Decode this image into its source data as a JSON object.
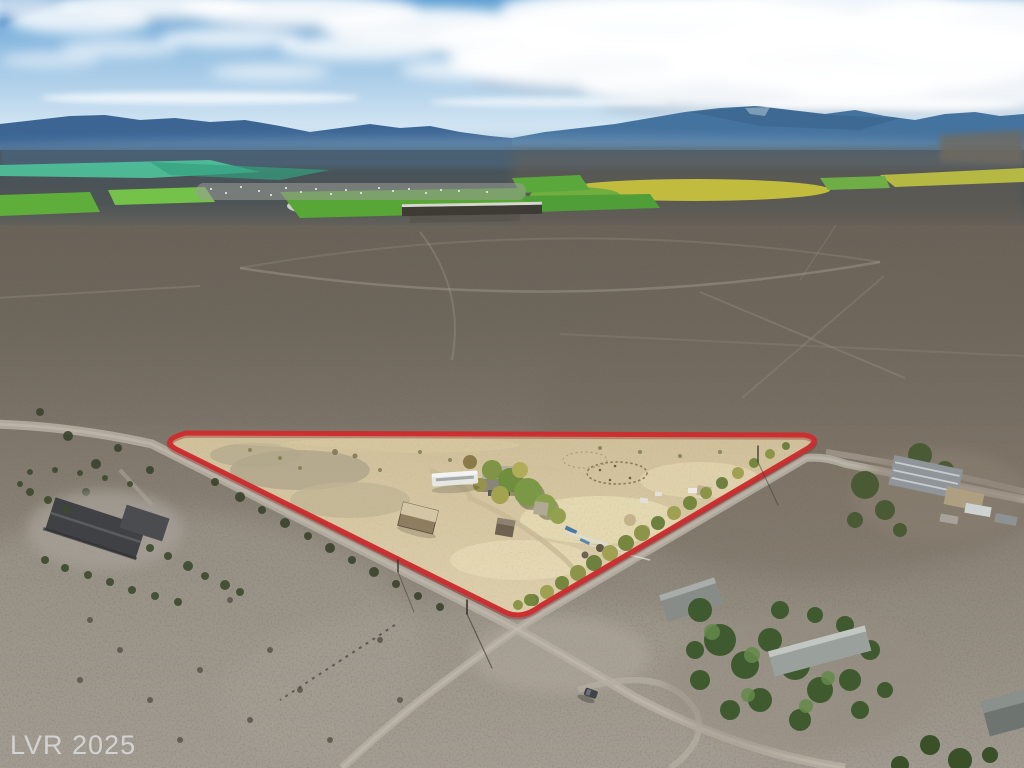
{
  "watermark": {
    "text": "LVR 2025"
  },
  "photo": {
    "boundary_color": "#cc2d2f",
    "palette": {
      "sky_blue": "#5f9fd4",
      "cloud_white": "#ffffff",
      "mountain_blue_left": "#3c6594",
      "mountain_blue_right": "#45739f",
      "haze": "#8fb0c8",
      "valley_dark": "#46525a",
      "field_green": "#57a636",
      "field_bright_green": "#74c24a",
      "field_yellow": "#c2bc3e",
      "field_teal": "#4fc39a",
      "desert_dark": "#6a6257",
      "desert_light": "#a19a90",
      "road_dirt": "#b4ada1",
      "parcel_sand": "#cfc09a",
      "tree_green": "#527040",
      "roof_dark": "#3f4144",
      "rv_white": "#e6e6e2",
      "watermark_gray": "#e6e8ea"
    }
  }
}
